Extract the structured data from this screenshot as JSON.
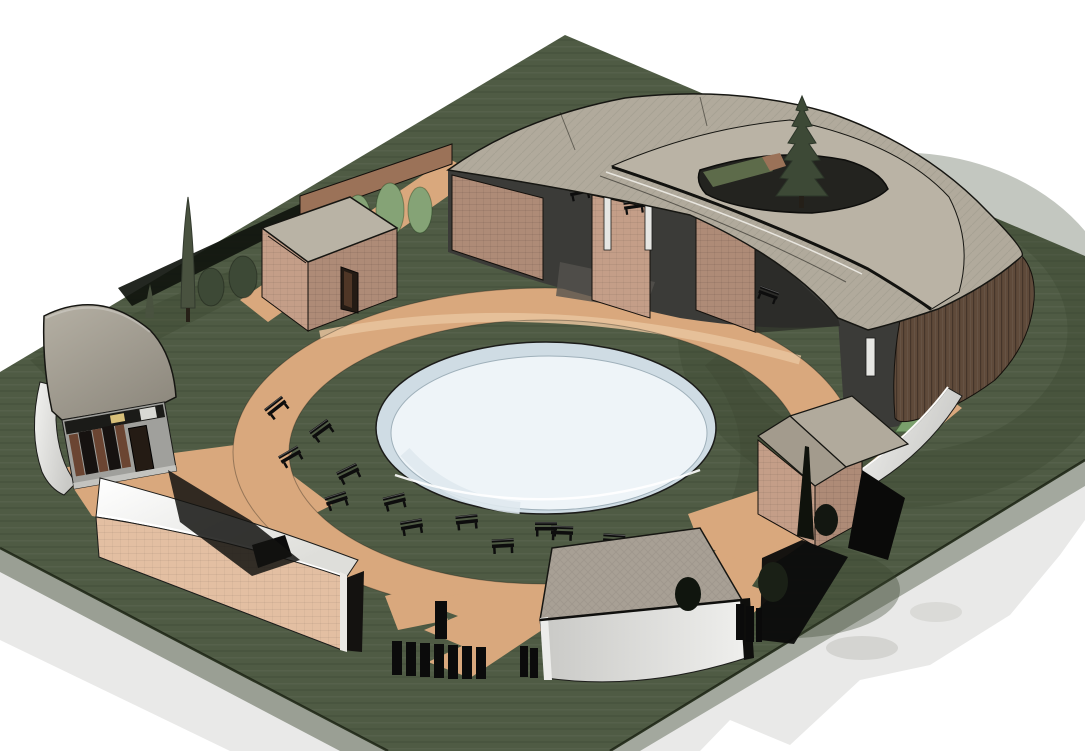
{
  "canvas": {
    "width": 1085,
    "height": 751,
    "background": "#ffffff"
  },
  "colors": {
    "background": "#ffffff",
    "shadow": "#e9e9e8",
    "outline": "#1c1c1a",
    "grass": "#4f5b44",
    "grass_dark": "#39452f",
    "grass_edge": "#242b1c",
    "path": "#d9a87d",
    "path_light": "#e8c49e",
    "pond_rim": "#cfdce4",
    "pond_water": "#eef4f8",
    "pond_shade": "#dfe9ee",
    "roof_main": "#b1aa9c",
    "roof_upper": "#bab3a5",
    "roof_gray": "#a8a095",
    "roof_warm": "#b9b3a5",
    "roof_shade": "#a39b8d",
    "roof_gray_hi": "#b5b0a4",
    "roof_gray_lo": "#8f8a7f",
    "roof_white_hi": "#ffffff",
    "roof_white_lo": "#dededa",
    "wall_white_hi": "#f2f2f0",
    "wall_white_lo": "#c9c9c6",
    "wall_bottom_hi": "#c9c9c6",
    "wall_bottom_lo": "#f0f0ee",
    "brick_light": "#c49e88",
    "brick_mid": "#ae8b77",
    "brick_pink": "#e3bfa2",
    "brick_wall": "#9b7258",
    "wood": "#5f4a3a",
    "facade_gray": "#a0a09c",
    "interior": "#3b3b38",
    "interior_deep": "#23231f",
    "floor_light": "#55534d",
    "tree_dark": "#3d4936",
    "tree_cypress": "#49523f",
    "tree_light": "#85a376",
    "tree_green": "#7aa06c",
    "tree_black": "#10150e",
    "courtyard_green": "#5d6b4a",
    "bench": "#0d0d0d",
    "column_white": "#e6e6e3",
    "door_dark": "#241b14",
    "door_leaf": "#4f3626",
    "shutter_brown": "#6b4532",
    "glass_dark": "#161210",
    "accent_yellow": "#d8c07a",
    "fence": "#0b0b0b"
  },
  "scene": {
    "type": "3d-architectural-site-render",
    "view": "aerial axonometric",
    "ground": {
      "label": "landscaped parcel",
      "shape": "parallelogram"
    },
    "water": {
      "label": "circular reflecting pool",
      "position": "center"
    },
    "walkways": {
      "label": "circular tan walkway ring with radial paths"
    },
    "buildings": [
      {
        "id": "crescent-pavilion",
        "label": "large crescent building with two-tier roof and roof courtyard tree",
        "position": "north-east"
      },
      {
        "id": "garden-cube",
        "label": "small brick cube outbuilding",
        "position": "north-west"
      },
      {
        "id": "west-gatehouse",
        "label": "gatehouse with curved gray roof, shuttered windows",
        "position": "west"
      },
      {
        "id": "south-arc-hall",
        "label": "curved hall with white roof and pink brick wall",
        "position": "south-west"
      },
      {
        "id": "south-pavilion",
        "label": "pavilion with hatched gray roof and curved white wall",
        "position": "south"
      },
      {
        "id": "east-pavilion",
        "label": "small brick pavilion with hip roof",
        "position": "east"
      }
    ],
    "site_furniture": {
      "benches_on_lawn": 12,
      "benches_under_canopy": 4,
      "fence_rows": 3
    },
    "vegetation": {
      "cypress_trees": 3,
      "round_shrubs": 2,
      "light_green_trees": 3,
      "courtyard_conifer": 1,
      "east_conifer": 1
    }
  }
}
